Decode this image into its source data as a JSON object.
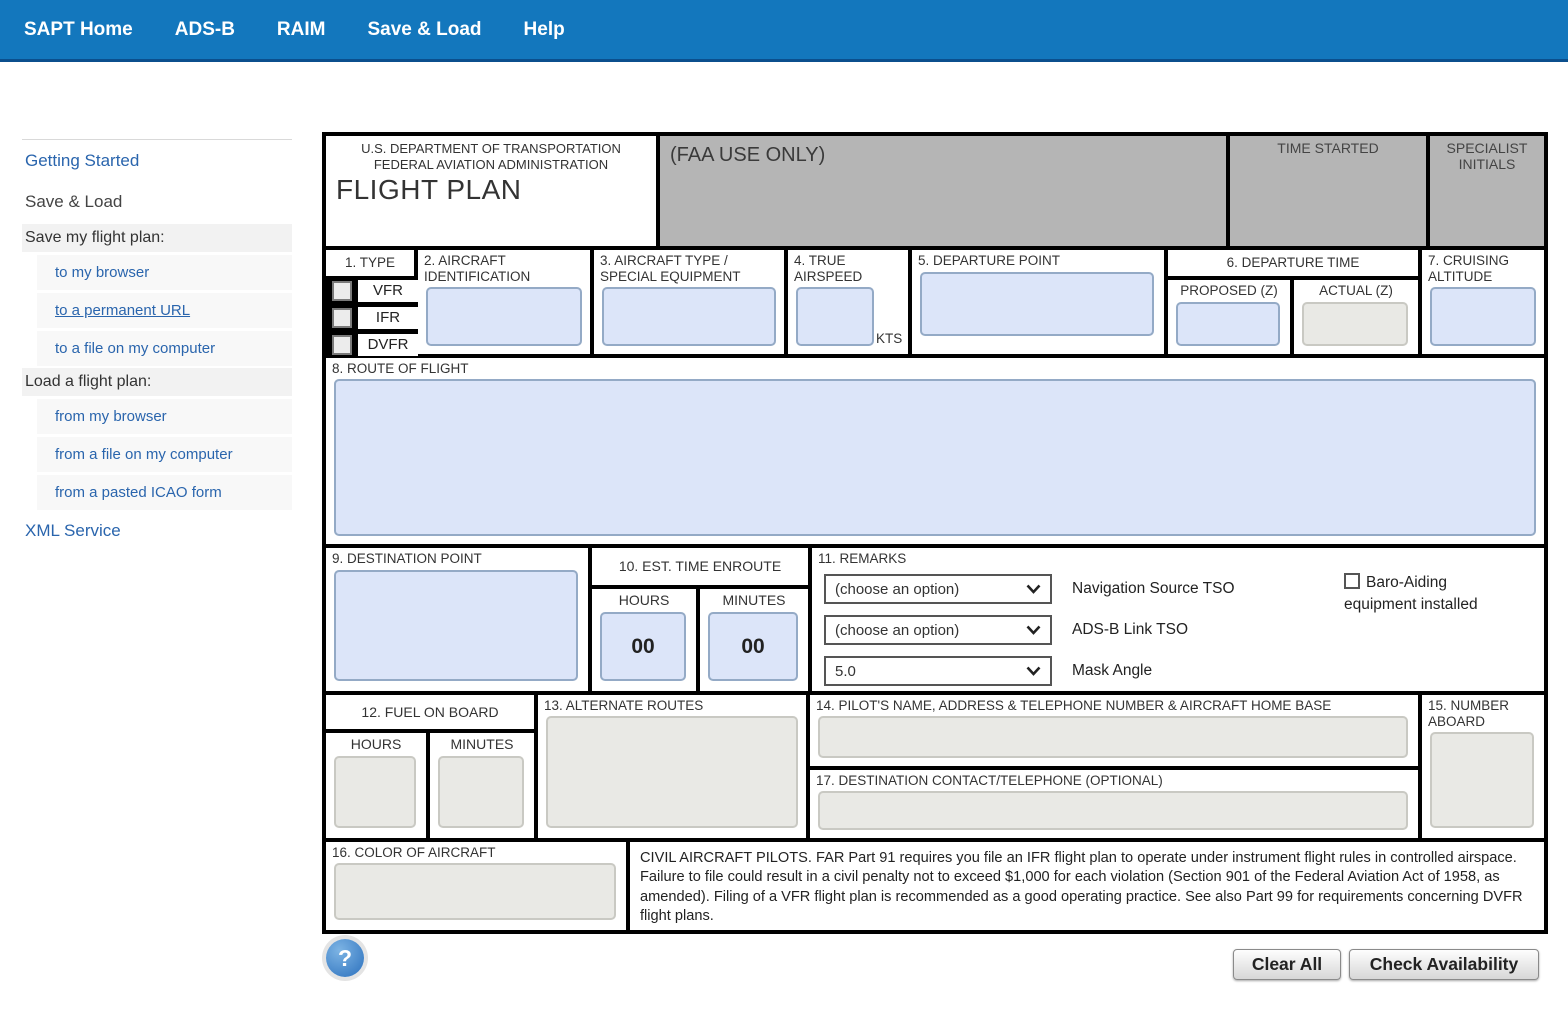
{
  "nav": {
    "items": [
      {
        "label": "SAPT Home"
      },
      {
        "label": "ADS-B"
      },
      {
        "label": "RAIM"
      },
      {
        "label": "Save & Load"
      },
      {
        "label": "Help"
      }
    ]
  },
  "sidebar": {
    "getting_started": "Getting Started",
    "current_page": "Save & Load",
    "save_header": "Save my flight plan:",
    "save_links": [
      "to my browser",
      "to a permanent URL",
      "to a file on my computer"
    ],
    "load_header": "Load a flight plan:",
    "load_links": [
      "from my browser",
      "from a file on my computer",
      "from a pasted ICAO form"
    ],
    "xml_service": "XML Service"
  },
  "form": {
    "header": {
      "dept_line1": "U.S. DEPARTMENT OF TRANSPORTATION",
      "dept_line2": "FEDERAL AVIATION ADMINISTRATION",
      "title": "FLIGHT PLAN",
      "faa_use_only": "(FAA USE ONLY)",
      "time_started": "TIME STARTED",
      "specialist_initials": "SPECIALIST INITIALS"
    },
    "type": {
      "label": "1. TYPE",
      "options": [
        "VFR",
        "IFR",
        "DVFR"
      ]
    },
    "aircraft_id": {
      "label": "2. AIRCRAFT IDENTIFICATION",
      "value": ""
    },
    "aircraft_type": {
      "label": "3. AIRCRAFT TYPE / SPECIAL EQUIPMENT",
      "value": ""
    },
    "true_airspeed": {
      "label": "4. TRUE AIRSPEED",
      "unit": "KTS",
      "value": ""
    },
    "departure_point": {
      "label": "5. DEPARTURE POINT",
      "value": ""
    },
    "departure_time": {
      "label": "6. DEPARTURE TIME",
      "proposed_label": "PROPOSED (Z)",
      "actual_label": "ACTUAL (Z)",
      "proposed": "",
      "actual": ""
    },
    "cruising_altitude": {
      "label": "7. CRUISING ALTITUDE",
      "value": ""
    },
    "route": {
      "label": "8. ROUTE OF FLIGHT",
      "value": ""
    },
    "destination": {
      "label": "9. DESTINATION POINT",
      "value": ""
    },
    "est_time_enroute": {
      "label": "10. EST. TIME ENROUTE",
      "hours_label": "HOURS",
      "minutes_label": "MINUTES",
      "hours": "00",
      "minutes": "00"
    },
    "remarks": {
      "label": "11. REMARKS",
      "nav_source": {
        "value": "(choose an option)",
        "label": "Navigation Source TSO"
      },
      "adsb_link": {
        "value": "(choose an option)",
        "label": "ADS-B Link TSO"
      },
      "mask_angle": {
        "value": "5.0",
        "label": "Mask Angle"
      },
      "baro": {
        "label_line1": "Baro-Aiding",
        "label_line2": "equipment installed",
        "checked": false
      }
    },
    "fuel": {
      "label": "12. FUEL ON BOARD",
      "hours_label": "HOURS",
      "minutes_label": "MINUTES",
      "hours": "",
      "minutes": ""
    },
    "alternate": {
      "label": "13. ALTERNATE ROUTES",
      "value": ""
    },
    "pilot": {
      "label": "14. PILOT'S NAME, ADDRESS & TELEPHONE NUMBER & AIRCRAFT HOME BASE",
      "value": ""
    },
    "number_aboard": {
      "label": "15. NUMBER ABOARD",
      "value": ""
    },
    "color_of_aircraft": {
      "label": "16. COLOR OF AIRCRAFT",
      "value": ""
    },
    "dest_contact": {
      "label": "17. DESTINATION CONTACT/TELEPHONE (OPTIONAL)",
      "value": ""
    },
    "civil_notice": "CIVIL AIRCRAFT PILOTS. FAR Part 91 requires you file an IFR flight plan to operate under instrument flight rules in controlled airspace. Failure to file could result in a civil penalty not to exceed $1,000 for each violation (Section 901 of the Federal Aviation Act of 1958, as amended). Filing of a VFR flight plan is recommended as a good operating practice. See also Part 99 for requirements concerning DVFR flight plans."
  },
  "footer": {
    "help": "?",
    "clear_all": "Clear All",
    "check_availability": "Check Availability"
  },
  "colors": {
    "nav_blue": "#1377bd",
    "link_blue": "#2a65ad",
    "input_blue": "#dce5f9",
    "input_blue_border": "#94aac6",
    "gray_box": "#b5b5b5",
    "input_gray": "#e9e9e5"
  }
}
